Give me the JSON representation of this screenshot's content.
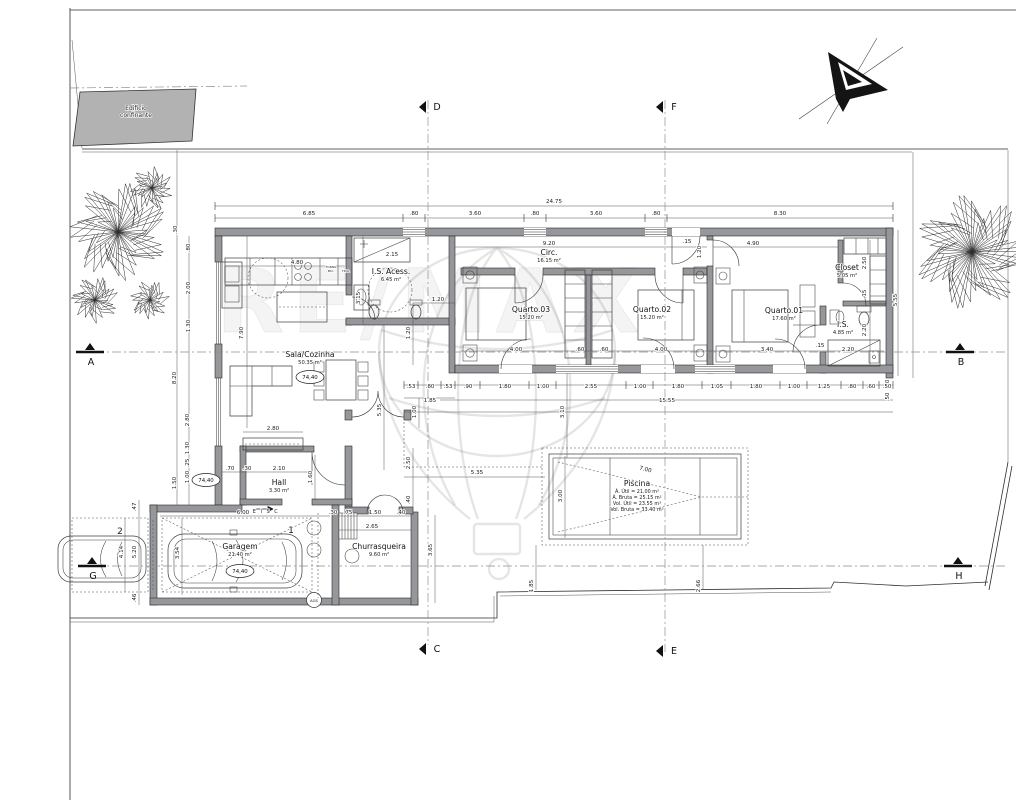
{
  "drawing": {
    "watermark_text": "RE/MAX",
    "site": {
      "adjacent_building_line1": "Edificio",
      "adjacent_building_line2": "confinante"
    },
    "rooms": [
      {
        "name": "Sala/Cozinha",
        "area": "50.35 m²",
        "x": 310,
        "y": 357
      },
      {
        "name": "I.S. Acess.",
        "area": "6.45 m²",
        "x": 391,
        "y": 274
      },
      {
        "name": "Circ.",
        "area": "16.15 m²",
        "x": 549,
        "y": 255
      },
      {
        "name": "Quarto.03",
        "area": "15.20 m²",
        "x": 531,
        "y": 312
      },
      {
        "name": "Quarto.02",
        "area": "15.20 m²",
        "x": 652,
        "y": 312
      },
      {
        "name": "Quarto.01",
        "area": "17.60 m²",
        "x": 784,
        "y": 313
      },
      {
        "name": "Closet",
        "area": "5.05 m²",
        "x": 847,
        "y": 270
      },
      {
        "name": "I.S.",
        "area": "4.85 m²",
        "x": 843,
        "y": 327
      },
      {
        "name": "Hall",
        "area": "3.30 m²",
        "x": 279,
        "y": 485
      },
      {
        "name": "Garagem",
        "area": "21.40 m²",
        "x": 240,
        "y": 549
      },
      {
        "name": "Churrasqueira",
        "area": "9.60 m²",
        "x": 379,
        "y": 549
      }
    ],
    "pool_label": {
      "title": "Piscina",
      "x": 637,
      "y": 486,
      "lines": [
        "Á. Útil = 21.00 m²",
        "Á. Bruta = 25.15 m²",
        "Vol. Útil = 23.55 m³",
        "Vol. Bruta = 33.40 m³"
      ]
    },
    "level_markers": [
      {
        "value": "74,40",
        "x": 310,
        "y": 377
      },
      {
        "value": "74,40",
        "x": 206,
        "y": 480
      },
      {
        "value": "74,40",
        "x": 240,
        "y": 571
      }
    ],
    "section_markers": [
      {
        "label": "A",
        "x": 100,
        "y": 352,
        "type": "h"
      },
      {
        "label": "B",
        "x": 970,
        "y": 352,
        "type": "h"
      },
      {
        "label": "G",
        "x": 102,
        "y": 566,
        "type": "h"
      },
      {
        "label": "H",
        "x": 968,
        "y": 566,
        "type": "h"
      },
      {
        "label": "D",
        "x": 428,
        "y": 107,
        "type": "v"
      },
      {
        "label": "F",
        "x": 665,
        "y": 107,
        "type": "v"
      },
      {
        "label": "C",
        "x": 428,
        "y": 649,
        "type": "v"
      },
      {
        "label": "E",
        "x": 665,
        "y": 651,
        "type": "v"
      }
    ],
    "dimensions": [
      {
        "t": "24.75",
        "x": 554,
        "y": 203
      },
      {
        "t": "6.85",
        "x": 309,
        "y": 215
      },
      {
        "t": ".80",
        "x": 414,
        "y": 215
      },
      {
        "t": "3.60",
        "x": 475,
        "y": 215
      },
      {
        "t": ".80",
        "x": 535,
        "y": 215
      },
      {
        "t": "3.60",
        "x": 596,
        "y": 215
      },
      {
        "t": ".80",
        "x": 656,
        "y": 215
      },
      {
        "t": "8.30",
        "x": 780,
        "y": 215
      },
      {
        "t": "4.80",
        "x": 297,
        "y": 264
      },
      {
        "t": "2.15",
        "x": 392,
        "y": 256
      },
      {
        "t": "9.20",
        "x": 549,
        "y": 245
      },
      {
        "t": "4.90",
        "x": 753,
        "y": 245
      },
      {
        "t": ".15",
        "x": 687,
        "y": 243
      },
      {
        "t": "1.20",
        "x": 701,
        "y": 252,
        "r": -90
      },
      {
        "t": ".30",
        "x": 177,
        "y": 230,
        "r": -90
      },
      {
        "t": ".80",
        "x": 190,
        "y": 248,
        "r": -90
      },
      {
        "t": "2.00",
        "x": 190,
        "y": 288,
        "r": -90
      },
      {
        "t": "1.30",
        "x": 190,
        "y": 326,
        "r": -90
      },
      {
        "t": "8.20",
        "x": 176,
        "y": 378,
        "r": -90
      },
      {
        "t": "2.80",
        "x": 189,
        "y": 420,
        "r": -90
      },
      {
        "t": "1.30",
        "x": 189,
        "y": 448,
        "r": -90
      },
      {
        "t": ".25",
        "x": 189,
        "y": 463,
        "r": -90
      },
      {
        "t": "1.00",
        "x": 189,
        "y": 477,
        "r": -90
      },
      {
        "t": "1.50",
        "x": 176,
        "y": 483,
        "r": -90
      },
      {
        "t": "7.90",
        "x": 243,
        "y": 333,
        "r": -90
      },
      {
        "t": "3.15",
        "x": 360,
        "y": 298,
        "r": -90
      },
      {
        "t": "1.20",
        "x": 438,
        "y": 301
      },
      {
        "t": "1.20",
        "x": 410,
        "y": 333,
        "r": -90
      },
      {
        "t": "4.00",
        "x": 516,
        "y": 351
      },
      {
        "t": ".60",
        "x": 580,
        "y": 351
      },
      {
        "t": ".60",
        "x": 604,
        "y": 351
      },
      {
        "t": "4.00",
        "x": 661,
        "y": 351
      },
      {
        "t": "3.40",
        "x": 767,
        "y": 351
      },
      {
        "t": ".15",
        "x": 820,
        "y": 347
      },
      {
        "t": "2.20",
        "x": 848,
        "y": 351
      },
      {
        "t": "2.50",
        "x": 866,
        "y": 263,
        "r": -90
      },
      {
        "t": ".15",
        "x": 866,
        "y": 294,
        "r": -90
      },
      {
        "t": "2.20",
        "x": 866,
        "y": 330,
        "r": -90
      },
      {
        "t": "5.55",
        "x": 897,
        "y": 300,
        "r": -90
      },
      {
        "t": ".50",
        "x": 889,
        "y": 384,
        "r": -90
      },
      {
        "t": ".50",
        "x": 889,
        "y": 397,
        "r": -90
      },
      {
        "t": ".53",
        "x": 411,
        "y": 388
      },
      {
        "t": ".80",
        "x": 430,
        "y": 388
      },
      {
        "t": ".53",
        "x": 448,
        "y": 388
      },
      {
        "t": ".90",
        "x": 468,
        "y": 388
      },
      {
        "t": "1.80",
        "x": 505,
        "y": 388
      },
      {
        "t": "1.00",
        "x": 543,
        "y": 388
      },
      {
        "t": "2.55",
        "x": 591,
        "y": 388
      },
      {
        "t": "1.00",
        "x": 640,
        "y": 388
      },
      {
        "t": "1.80",
        "x": 678,
        "y": 388
      },
      {
        "t": "1.05",
        "x": 717,
        "y": 388
      },
      {
        "t": "1.80",
        "x": 756,
        "y": 388
      },
      {
        "t": "1.00",
        "x": 794,
        "y": 388
      },
      {
        "t": "1.25",
        "x": 824,
        "y": 388
      },
      {
        "t": ".80",
        "x": 852,
        "y": 388
      },
      {
        "t": ".60",
        "x": 871,
        "y": 388
      },
      {
        "t": ".50",
        "x": 887,
        "y": 388
      },
      {
        "t": "1.85",
        "x": 430,
        "y": 402
      },
      {
        "t": "15.55",
        "x": 667,
        "y": 402
      },
      {
        "t": "3.10",
        "x": 564,
        "y": 412,
        "r": -90
      },
      {
        "t": "1.00",
        "x": 416,
        "y": 412,
        "r": -90
      },
      {
        "t": "5.35",
        "x": 381,
        "y": 410,
        "r": -90
      },
      {
        "t": "2.80",
        "x": 273,
        "y": 430
      },
      {
        "t": ".70",
        "x": 230,
        "y": 470
      },
      {
        "t": ".30",
        "x": 247,
        "y": 470
      },
      {
        "t": "2.10",
        "x": 279,
        "y": 470
      },
      {
        "t": "1.60",
        "x": 312,
        "y": 477,
        "r": -90
      },
      {
        "t": "2.50",
        "x": 410,
        "y": 463,
        "r": -90
      },
      {
        "t": ".40",
        "x": 410,
        "y": 500,
        "r": -90
      },
      {
        "t": "6.00",
        "x": 243,
        "y": 514
      },
      {
        "t": ".30",
        "x": 333,
        "y": 514
      },
      {
        "t": ".75",
        "x": 348,
        "y": 514
      },
      {
        "t": "1.50",
        "x": 375,
        "y": 514
      },
      {
        "t": ".40",
        "x": 401,
        "y": 514
      },
      {
        "t": "2.65",
        "x": 372,
        "y": 528
      },
      {
        "t": "3.65",
        "x": 432,
        "y": 550,
        "r": -90
      },
      {
        "t": "3.54",
        "x": 179,
        "y": 553,
        "r": -90
      },
      {
        "t": ".47",
        "x": 136,
        "y": 507,
        "r": -90
      },
      {
        "t": "5.20",
        "x": 136,
        "y": 552,
        "r": -90
      },
      {
        "t": "4.14",
        "x": 123,
        "y": 552,
        "r": -90
      },
      {
        "t": ".46",
        "x": 136,
        "y": 598,
        "r": -90
      },
      {
        "t": "5.35",
        "x": 477,
        "y": 474
      },
      {
        "t": "3.00",
        "x": 562,
        "y": 496,
        "r": -90
      },
      {
        "t": "7.00",
        "x": 645,
        "y": 471,
        "r": 14
      },
      {
        "t": "1.85",
        "x": 533,
        "y": 586,
        "r": -90
      },
      {
        "t": "2.66",
        "x": 700,
        "y": 586,
        "r": -90
      }
    ],
    "misc_labels": [
      {
        "t": "E I S C",
        "x": 266,
        "y": 513,
        "s": 5
      },
      {
        "t": "AGS",
        "x": 314,
        "y": 602,
        "s": 3.8
      },
      {
        "t": "2",
        "x": 120,
        "y": 534,
        "s": 9
      },
      {
        "t": "1",
        "x": 291,
        "y": 533,
        "s": 9
      },
      {
        "t": "FORNO",
        "x": 331,
        "y": 268,
        "s": 3
      },
      {
        "t": "MIC.",
        "x": 331,
        "y": 272,
        "s": 3
      },
      {
        "t": "FRIG.",
        "x": 346,
        "y": 272,
        "s": 3
      }
    ]
  }
}
